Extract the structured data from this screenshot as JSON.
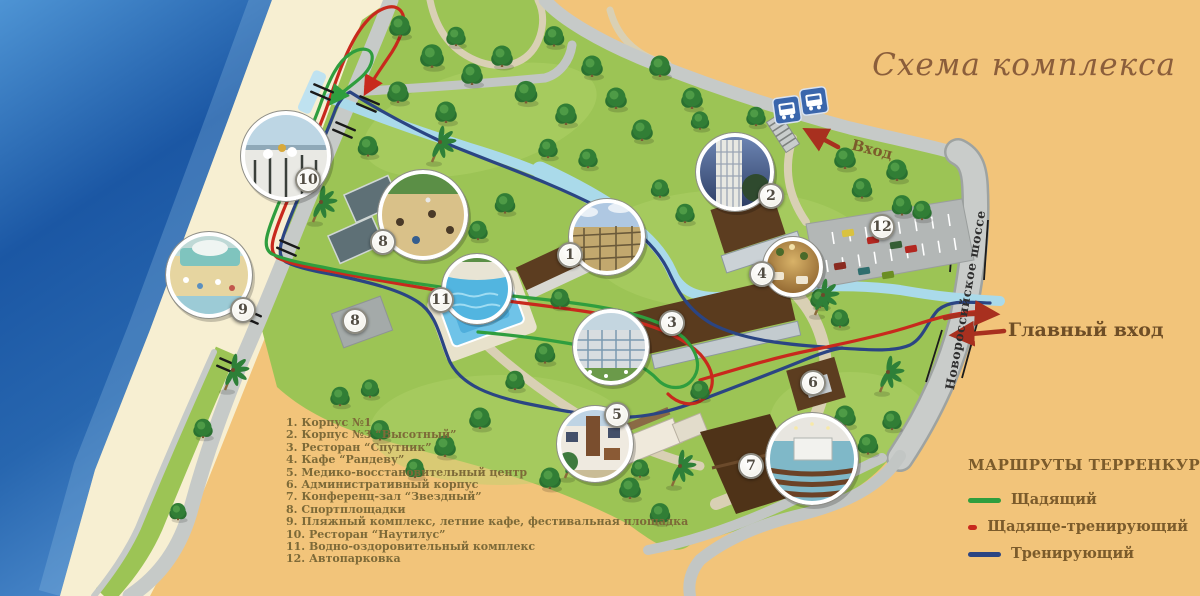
{
  "title": "Схема комплекса",
  "entrance": {
    "top_label": "Вход",
    "main_label": "Главный вход"
  },
  "highway_label": "Новороссийское шоссе",
  "legend": {
    "items": [
      {
        "num": "1",
        "label": "Корпус №1"
      },
      {
        "num": "2",
        "label": "Корпус №3 “Высотный”"
      },
      {
        "num": "3",
        "label": "Ресторан “Спутник”"
      },
      {
        "num": "4",
        "label": "Кафе “Рандеву”"
      },
      {
        "num": "5",
        "label": "Медико-восстановительный центр"
      },
      {
        "num": "6",
        "label": "Административный корпус"
      },
      {
        "num": "7",
        "label": "Конференц-зал “Звездный”"
      },
      {
        "num": "8",
        "label": "Спортплощадки"
      },
      {
        "num": "9",
        "label": "Пляжный комплекс, летние кафе, фестивальная площадка"
      },
      {
        "num": "10",
        "label": "Ресторан “Наутилус”"
      },
      {
        "num": "11",
        "label": "Водно-оздоровительный комплекс"
      },
      {
        "num": "12",
        "label": "Автопарковка"
      }
    ]
  },
  "routes_legend": {
    "title": "МАРШРУТЫ ТЕРРЕНКУРА",
    "items": [
      {
        "label": "Щадящий",
        "color": "#2F9E3E"
      },
      {
        "label": "Щадяще-тренирующий",
        "color": "#C8291D"
      },
      {
        "label": "Тренирующий",
        "color": "#2B4583"
      }
    ]
  },
  "map": {
    "markers": [
      {
        "n": "1",
        "x": 570,
        "y": 255
      },
      {
        "n": "2",
        "x": 771,
        "y": 196
      },
      {
        "n": "3",
        "x": 672,
        "y": 323
      },
      {
        "n": "4",
        "x": 762,
        "y": 274
      },
      {
        "n": "5",
        "x": 617,
        "y": 415
      },
      {
        "n": "6",
        "x": 813,
        "y": 383
      },
      {
        "n": "7",
        "x": 751,
        "y": 466
      },
      {
        "n": "8",
        "x": 383,
        "y": 242
      },
      {
        "n": "8",
        "x": 355,
        "y": 321
      },
      {
        "n": "9",
        "x": 243,
        "y": 310
      },
      {
        "n": "10",
        "x": 308,
        "y": 180
      },
      {
        "n": "11",
        "x": 441,
        "y": 300
      },
      {
        "n": "12",
        "x": 882,
        "y": 227
      }
    ]
  },
  "icons": {
    "bus_stop": "bus-icon",
    "stairs": "stairs-icon",
    "entrance_arrow": "red-arrow-icon"
  },
  "colors": {
    "land": "#F2C47A",
    "sea": "#1B57A4",
    "grass": "#9CC455",
    "road": "#C6CAC8",
    "canal": "#AADAEA"
  }
}
